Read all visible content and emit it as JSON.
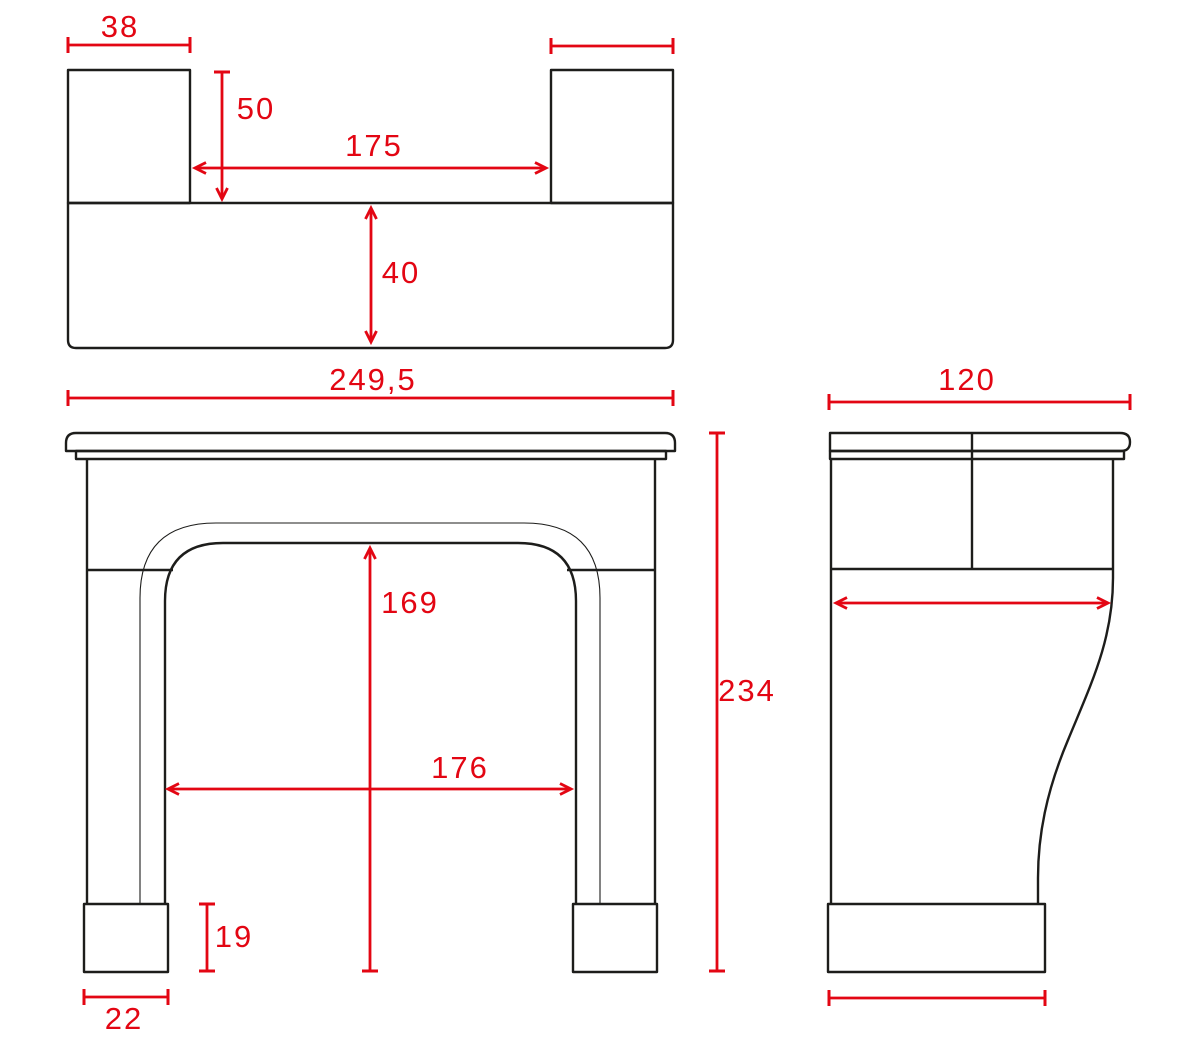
{
  "colors": {
    "dimension_red": "#e30613",
    "outline_black": "#1d1d1b",
    "background": "#ffffff"
  },
  "views": {
    "top": {
      "dims": {
        "block_width": "38",
        "block_depth": "50",
        "between_blocks": "175",
        "slab_depth": "40",
        "overall_width": "249,5"
      }
    },
    "front": {
      "dims": {
        "opening_height": "169",
        "opening_width": "176",
        "overall_height": "234",
        "plinth_height": "19",
        "plinth_width": "22"
      }
    },
    "side": {
      "dims": {
        "overall_depth": "120"
      }
    }
  }
}
